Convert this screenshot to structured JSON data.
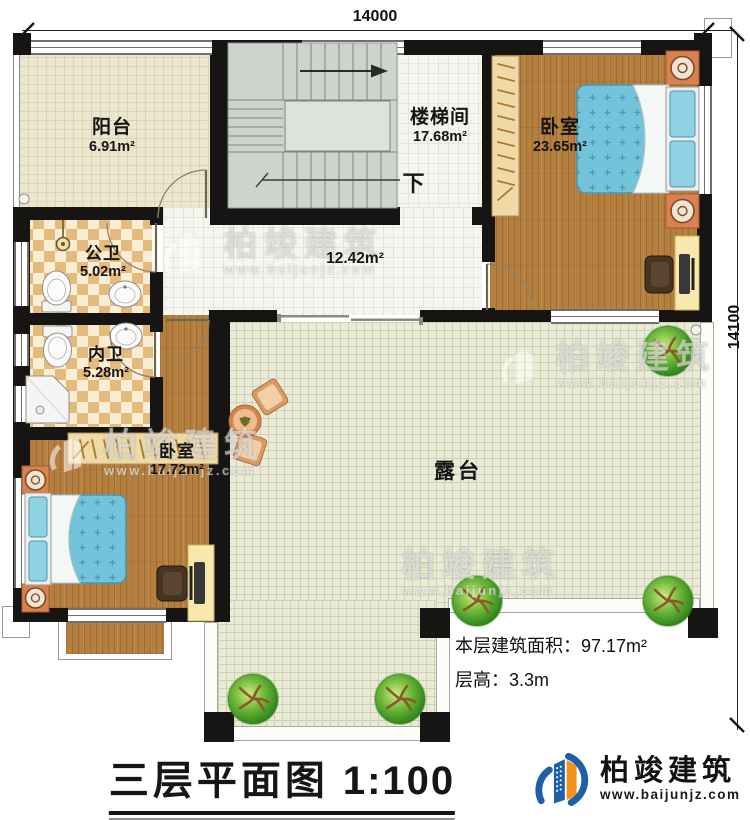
{
  "dimensions": {
    "top": "14000",
    "right": "14100"
  },
  "rooms": {
    "balcony": {
      "name": "阳台",
      "area": "6.91m²"
    },
    "stairwell": {
      "name": "楼梯间",
      "area": "17.68m²"
    },
    "bedroom_main": {
      "name": "卧室",
      "area": "23.65m²"
    },
    "public_bath": {
      "name": "公卫",
      "area": "5.02m²"
    },
    "private_bath": {
      "name": "内卫",
      "area": "5.28m²"
    },
    "hall": {
      "area": "12.42m²"
    },
    "bedroom_second": {
      "name": "卧室",
      "area": "17.72m²"
    },
    "terrace": {
      "name": "露台"
    }
  },
  "stairs": {
    "down_label": "下"
  },
  "notes": {
    "floor_area": "本层建筑面积：97.17m²",
    "floor_height": "层高：3.3m"
  },
  "title": {
    "text": "三层平面图",
    "scale": "1:100"
  },
  "brand": {
    "name": "柏竣建筑",
    "website": "www.baijunjz.com"
  },
  "watermark": {
    "name": "柏竣建筑",
    "website": "www.baijunjz.com"
  },
  "colors": {
    "wall": "#171513",
    "brand_blue": "#1d5fa8",
    "accent_orange": "#f2941c",
    "bed_blue": "#6fc0d8"
  }
}
